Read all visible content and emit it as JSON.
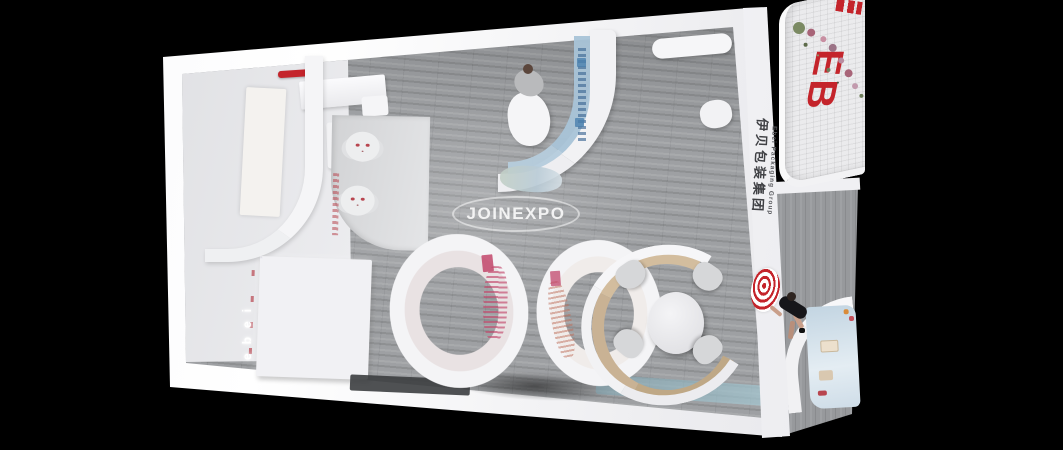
{
  "watermark": {
    "text": "JOINEXPO"
  },
  "branding": {
    "pillar_text_cn": "伊贝包装集团",
    "pillar_text_en": "Ebei Packaging Group",
    "outer_wall_letters": "EB",
    "shelf_wall_letters": "ebei"
  },
  "palette": {
    "background": "#000000",
    "booth_white": "#f3f3f5",
    "floor_gray": "#9d9fa2",
    "brand_red": "#c4242b",
    "graphic_blue": "#a9c4d8",
    "graphic_pink": "#c2476b",
    "wood_tan": "#c9b294",
    "tile_white": "#ebebed"
  }
}
